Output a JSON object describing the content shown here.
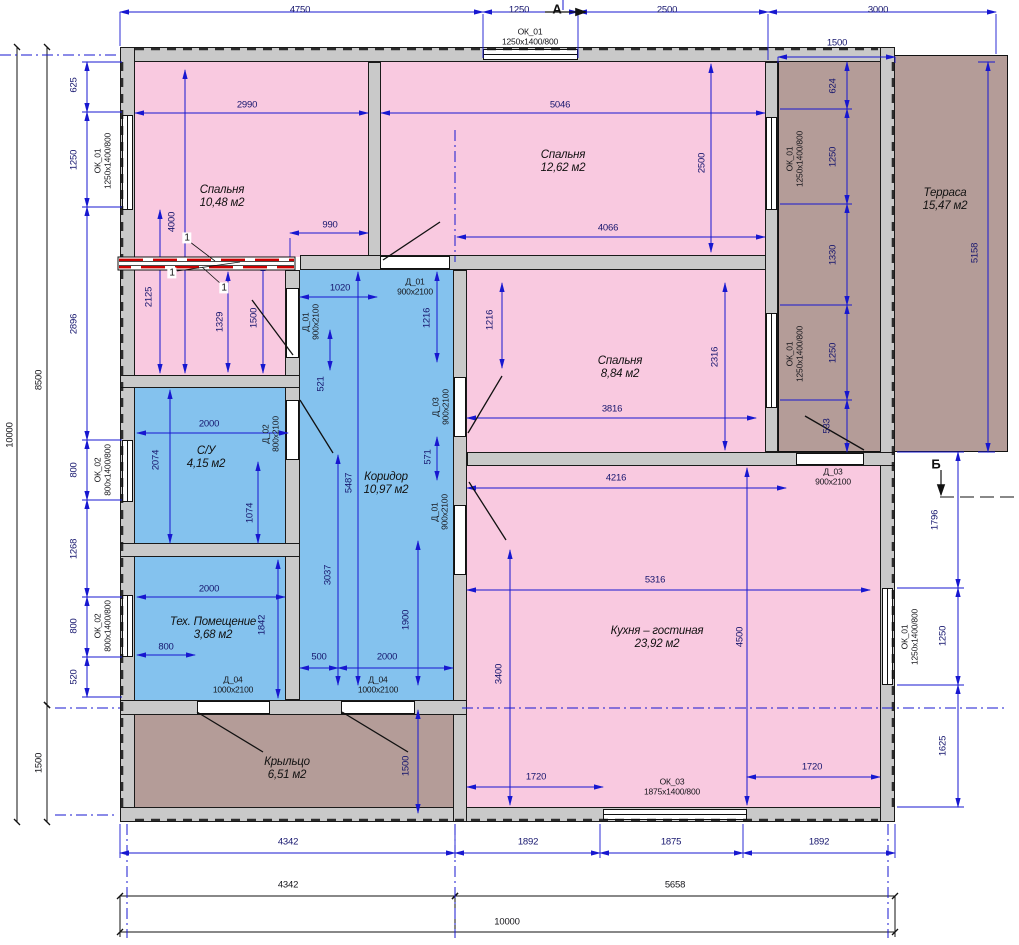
{
  "colors": {
    "bedroom_fill": "#f9c9e0",
    "wet_fill": "#84c2ee",
    "outdoor_fill": "#b49c98",
    "wall_fill": "#c9c9c9",
    "dim_line": "#1717d0",
    "partition_red": "#cc0000"
  },
  "rooms": [
    {
      "id": "bedroom-1",
      "label": "Спальня",
      "area": "10,48 м2"
    },
    {
      "id": "bedroom-2",
      "label": "Спальня",
      "area": "12,62 м2"
    },
    {
      "id": "bedroom-3",
      "label": "Спальня",
      "area": "8,84 м2"
    },
    {
      "id": "bathroom",
      "label": "С/У",
      "area": "4,15 м2"
    },
    {
      "id": "corridor",
      "label": "Коридор",
      "area": "10,97 м2"
    },
    {
      "id": "tech-room",
      "label": "Тех. Помещение",
      "area": "3,68 м2"
    },
    {
      "id": "kitchen-living",
      "label": "Кухня – гостиная",
      "area": "23,92 м2"
    },
    {
      "id": "terrace",
      "label": "Терраса",
      "area": "15,47 м2"
    },
    {
      "id": "porch",
      "label": "Крыльцо",
      "area": "6,51 м2"
    }
  ],
  "labels": [
    {
      "t": "4750",
      "x": 300,
      "y": 11,
      "k": "dim"
    },
    {
      "t": "1250",
      "x": 519,
      "y": 11,
      "k": "dim"
    },
    {
      "t": "2500",
      "x": 667,
      "y": 11,
      "k": "dim"
    },
    {
      "t": "3000",
      "x": 878,
      "y": 11,
      "k": "dim"
    },
    {
      "t": "А",
      "x": 557,
      "y": 10,
      "k": "axis"
    },
    {
      "t": "ОК_01\n1250x1400/800",
      "x": 530,
      "y": 37,
      "k": "tag"
    },
    {
      "t": "1500",
      "x": 837,
      "y": 44,
      "k": "dim"
    },
    {
      "t": "10000",
      "x": 11,
      "y": 435,
      "r": 1,
      "k": "dim2"
    },
    {
      "t": "8500",
      "x": 40,
      "y": 380,
      "r": 1,
      "k": "dim2"
    },
    {
      "t": "1500",
      "x": 40,
      "y": 763,
      "r": 1,
      "k": "dim2"
    },
    {
      "t": "625",
      "x": 75,
      "y": 85,
      "r": 1,
      "k": "dim"
    },
    {
      "t": "1250",
      "x": 75,
      "y": 160,
      "r": 1,
      "k": "dim"
    },
    {
      "t": "ОК_01\n1250x1400/800",
      "x": 103,
      "y": 161,
      "r": 1,
      "k": "tag"
    },
    {
      "t": "2896",
      "x": 75,
      "y": 324,
      "r": 1,
      "k": "dim"
    },
    {
      "t": "800",
      "x": 75,
      "y": 470,
      "r": 1,
      "k": "dim"
    },
    {
      "t": "ОК_02\n800x1400/800",
      "x": 103,
      "y": 470,
      "r": 1,
      "k": "tag"
    },
    {
      "t": "1268",
      "x": 75,
      "y": 549,
      "r": 1,
      "k": "dim"
    },
    {
      "t": "800",
      "x": 75,
      "y": 626,
      "r": 1,
      "k": "dim"
    },
    {
      "t": "ОК_02\n800x1400/800",
      "x": 103,
      "y": 626,
      "r": 1,
      "k": "tag"
    },
    {
      "t": "520",
      "x": 75,
      "y": 677,
      "r": 1,
      "k": "dim"
    },
    {
      "t": "5158",
      "x": 976,
      "y": 253,
      "r": 1,
      "k": "dim"
    },
    {
      "t": "Б",
      "x": 936,
      "y": 465,
      "k": "axis"
    },
    {
      "t": "1796",
      "x": 936,
      "y": 520,
      "r": 1,
      "k": "dim"
    },
    {
      "t": "1250",
      "x": 944,
      "y": 636,
      "r": 1,
      "k": "dim"
    },
    {
      "t": "ОК_01\n1250x1400/800",
      "x": 910,
      "y": 637,
      "r": 1,
      "k": "tag"
    },
    {
      "t": "1625",
      "x": 944,
      "y": 746,
      "r": 1,
      "k": "dim"
    },
    {
      "t": "624",
      "x": 834,
      "y": 86,
      "r": 1,
      "k": "dim"
    },
    {
      "t": "1250",
      "x": 834,
      "y": 157,
      "r": 1,
      "k": "dim"
    },
    {
      "t": "ОК_01\n1250x1400/800",
      "x": 795,
      "y": 159,
      "r": 1,
      "k": "tag"
    },
    {
      "t": "1330",
      "x": 834,
      "y": 255,
      "r": 1,
      "k": "dim"
    },
    {
      "t": "1250",
      "x": 834,
      "y": 353,
      "r": 1,
      "k": "dim"
    },
    {
      "t": "ОК_01\n1250x1400/800",
      "x": 795,
      "y": 354,
      "r": 1,
      "k": "tag"
    },
    {
      "t": "533",
      "x": 828,
      "y": 426,
      "r": 1,
      "k": "dim"
    },
    {
      "t": "4342",
      "x": 288,
      "y": 843,
      "k": "dim"
    },
    {
      "t": "1892",
      "x": 528,
      "y": 843,
      "k": "dim"
    },
    {
      "t": "1875",
      "x": 671,
      "y": 843,
      "k": "dim"
    },
    {
      "t": "1892",
      "x": 819,
      "y": 843,
      "k": "dim"
    },
    {
      "t": "4342",
      "x": 288,
      "y": 886,
      "k": "dim2"
    },
    {
      "t": "5658",
      "x": 675,
      "y": 886,
      "k": "dim2"
    },
    {
      "t": "10000",
      "x": 507,
      "y": 923,
      "k": "dim2"
    },
    {
      "t": "ОК_03\n1875x1400/800",
      "x": 672,
      "y": 787,
      "k": "tag"
    },
    {
      "t": "2990",
      "x": 247,
      "y": 106,
      "k": "dim"
    },
    {
      "t": "990",
      "x": 330,
      "y": 226,
      "k": "dim"
    },
    {
      "t": "4000",
      "x": 173,
      "y": 222,
      "r": 1,
      "k": "dim"
    },
    {
      "t": "2125",
      "x": 150,
      "y": 297,
      "r": 1,
      "k": "dim"
    },
    {
      "t": "1329",
      "x": 221,
      "y": 322,
      "r": 1,
      "k": "dim"
    },
    {
      "t": "1500",
      "x": 255,
      "y": 318,
      "r": 1,
      "k": "dim"
    },
    {
      "t": "1",
      "x": 187,
      "y": 238,
      "k": "pos"
    },
    {
      "t": "1",
      "x": 172,
      "y": 273,
      "k": "pos"
    },
    {
      "t": "1",
      "x": 224,
      "y": 288,
      "k": "pos"
    },
    {
      "t": "5046",
      "x": 560,
      "y": 106,
      "k": "dim"
    },
    {
      "t": "2500",
      "x": 703,
      "y": 163,
      "r": 1,
      "k": "dim"
    },
    {
      "t": "4066",
      "x": 608,
      "y": 229,
      "k": "dim"
    },
    {
      "t": "Д_01\n900x2100",
      "x": 415,
      "y": 287,
      "k": "tag"
    },
    {
      "t": "1216",
      "x": 491,
      "y": 320,
      "r": 1,
      "k": "dim"
    },
    {
      "t": "2316",
      "x": 716,
      "y": 357,
      "r": 1,
      "k": "dim"
    },
    {
      "t": "3816",
      "x": 612,
      "y": 410,
      "k": "dim"
    },
    {
      "t": "1020",
      "x": 340,
      "y": 289,
      "k": "dim"
    },
    {
      "t": "Д_01\n900x2100",
      "x": 311,
      "y": 322,
      "r": 1,
      "k": "tag"
    },
    {
      "t": "1216",
      "x": 428,
      "y": 318,
      "r": 1,
      "k": "dim"
    },
    {
      "t": "521",
      "x": 322,
      "y": 384,
      "r": 1,
      "k": "dim"
    },
    {
      "t": "Д_03\n900x2100",
      "x": 441,
      "y": 407,
      "r": 1,
      "k": "tag"
    },
    {
      "t": "571",
      "x": 429,
      "y": 457,
      "r": 1,
      "k": "dim"
    },
    {
      "t": "5487",
      "x": 350,
      "y": 483,
      "r": 1,
      "k": "dim"
    },
    {
      "t": "3037",
      "x": 329,
      "y": 575,
      "r": 1,
      "k": "dim"
    },
    {
      "t": "Д_01\n900x2100",
      "x": 440,
      "y": 512,
      "r": 1,
      "k": "tag"
    },
    {
      "t": "1900",
      "x": 407,
      "y": 620,
      "r": 1,
      "k": "dim"
    },
    {
      "t": "500",
      "x": 319,
      "y": 658,
      "k": "dim"
    },
    {
      "t": "2000",
      "x": 387,
      "y": 658,
      "k": "dim"
    },
    {
      "t": "Д_04\n1000x2100",
      "x": 378,
      "y": 685,
      "k": "tag"
    },
    {
      "t": "2000",
      "x": 209,
      "y": 425,
      "k": "dim"
    },
    {
      "t": "2074",
      "x": 157,
      "y": 460,
      "r": 1,
      "k": "dim"
    },
    {
      "t": "1074",
      "x": 251,
      "y": 513,
      "r": 1,
      "k": "dim"
    },
    {
      "t": "Д_02\n800x2100",
      "x": 271,
      "y": 434,
      "r": 1,
      "k": "tag"
    },
    {
      "t": "2000",
      "x": 209,
      "y": 590,
      "k": "dim"
    },
    {
      "t": "1842",
      "x": 263,
      "y": 625,
      "r": 1,
      "k": "dim"
    },
    {
      "t": "800",
      "x": 166,
      "y": 648,
      "k": "dim"
    },
    {
      "t": "Д_04\n1000x2100",
      "x": 233,
      "y": 685,
      "k": "tag"
    },
    {
      "t": "4216",
      "x": 616,
      "y": 479,
      "k": "dim"
    },
    {
      "t": "Д_03\n900x2100",
      "x": 833,
      "y": 477,
      "k": "tag"
    },
    {
      "t": "5316",
      "x": 655,
      "y": 581,
      "k": "dim"
    },
    {
      "t": "4500",
      "x": 741,
      "y": 637,
      "r": 1,
      "k": "dim"
    },
    {
      "t": "3400",
      "x": 500,
      "y": 674,
      "r": 1,
      "k": "dim"
    },
    {
      "t": "1720",
      "x": 536,
      "y": 778,
      "k": "dim"
    },
    {
      "t": "1720",
      "x": 812,
      "y": 768,
      "k": "dim"
    },
    {
      "t": "1500",
      "x": 407,
      "y": 766,
      "r": 1,
      "k": "dim"
    },
    {
      "t": "Спальня\n10,48 м2",
      "x": 222,
      "y": 197,
      "k": "room-lab"
    },
    {
      "t": "Спальня\n12,62 м2",
      "x": 563,
      "y": 162,
      "k": "room-lab"
    },
    {
      "t": "Спальня\n8,84 м2",
      "x": 620,
      "y": 368,
      "k": "room-lab"
    },
    {
      "t": "С/У\n4,15 м2",
      "x": 206,
      "y": 458,
      "k": "room-lab"
    },
    {
      "t": "Коридор\n10,97 м2",
      "x": 386,
      "y": 484,
      "k": "room-lab"
    },
    {
      "t": "Тех. Помещение\n3,68 м2",
      "x": 213,
      "y": 629,
      "k": "room-lab"
    },
    {
      "t": "Кухня – гостиная\n23,92 м2",
      "x": 657,
      "y": 638,
      "k": "room-lab"
    },
    {
      "t": "Терраса\n15,47 м2",
      "x": 945,
      "y": 200,
      "k": "room-lab"
    },
    {
      "t": "Крыльцо\n6,51 м2",
      "x": 287,
      "y": 769,
      "k": "room-lab"
    }
  ]
}
